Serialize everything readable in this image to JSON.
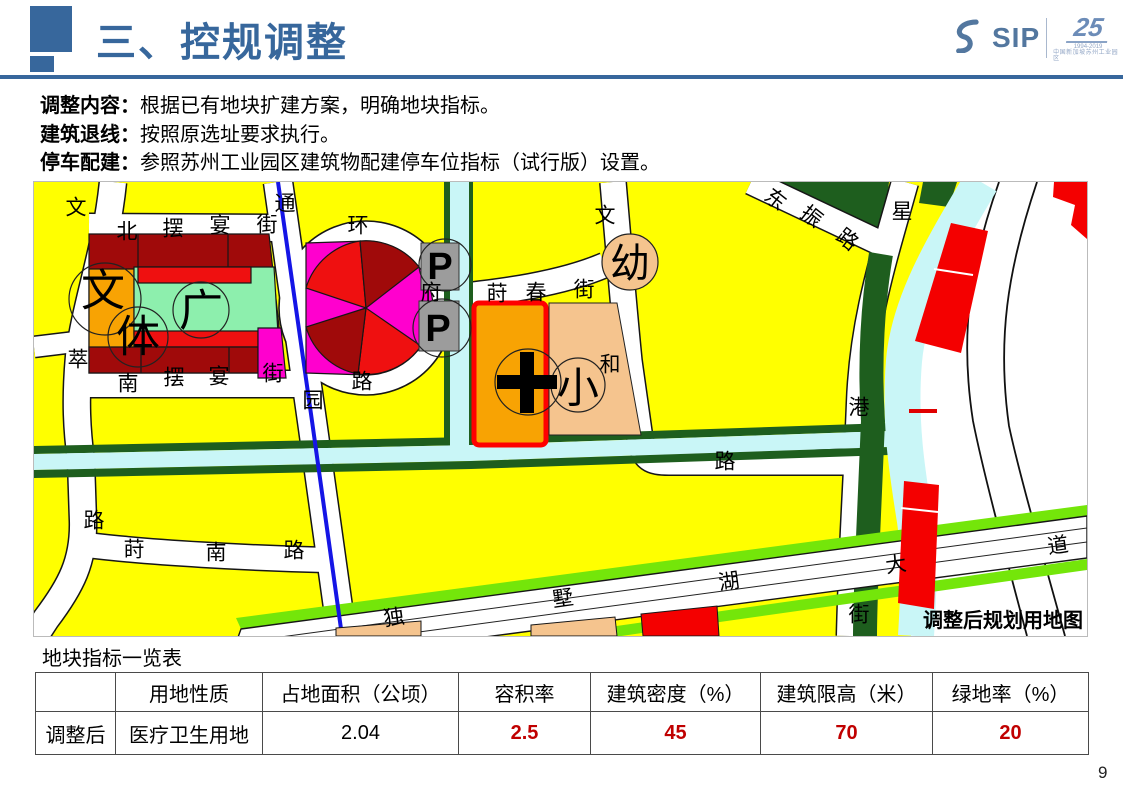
{
  "slide": {
    "title": "三、控规调整",
    "page_number": "9"
  },
  "logo": {
    "sip": "SIP",
    "anniversary": "25",
    "years": "1994-2019",
    "subtext": "中国新加坡苏州工业园区"
  },
  "bullets": [
    {
      "label": "调整内容：",
      "text": "根据已有地块扩建方案，明确地块指标。"
    },
    {
      "label": "建筑退线：",
      "text": "按照原选址要求执行。"
    },
    {
      "label": "停车配建：",
      "text": "参照苏州工业园区建筑物配建停车位指标（试行版）设置。"
    }
  ],
  "map": {
    "caption": "调整后规划用地图",
    "street_labels": [
      {
        "t": "文",
        "x": 75,
        "y": 207
      },
      {
        "t": "萃",
        "x": 77,
        "y": 359
      },
      {
        "t": "路",
        "x": 93,
        "y": 520
      },
      {
        "t": "北",
        "x": 126,
        "y": 231
      },
      {
        "t": "摆",
        "x": 172,
        "y": 228
      },
      {
        "t": "宴",
        "x": 219,
        "y": 225
      },
      {
        "t": "街",
        "x": 266,
        "y": 224
      },
      {
        "t": "通",
        "x": 284,
        "y": 203
      },
      {
        "t": "园",
        "x": 312,
        "y": 400
      },
      {
        "t": "环",
        "x": 357,
        "y": 225
      },
      {
        "t": "府",
        "x": 430,
        "y": 292
      },
      {
        "t": "路",
        "x": 361,
        "y": 381
      },
      {
        "t": "南",
        "x": 127,
        "y": 383
      },
      {
        "t": "摆",
        "x": 173,
        "y": 377
      },
      {
        "t": "宴",
        "x": 218,
        "y": 376
      },
      {
        "t": "街",
        "x": 272,
        "y": 373
      },
      {
        "t": "莳",
        "x": 496,
        "y": 293
      },
      {
        "t": "春",
        "x": 535,
        "y": 292
      },
      {
        "t": "街",
        "x": 583,
        "y": 289
      },
      {
        "t": "文",
        "x": 604,
        "y": 215
      },
      {
        "t": "和",
        "x": 609,
        "y": 364
      },
      {
        "t": "路",
        "x": 724,
        "y": 461
      },
      {
        "t": "东",
        "x": 774,
        "y": 199,
        "r": 38
      },
      {
        "t": "振",
        "x": 810,
        "y": 216,
        "r": 38
      },
      {
        "t": "路",
        "x": 846,
        "y": 239,
        "r": 38
      },
      {
        "t": "星",
        "x": 901,
        "y": 211
      },
      {
        "t": "港",
        "x": 858,
        "y": 407
      },
      {
        "t": "街",
        "x": 858,
        "y": 614
      },
      {
        "t": "莳",
        "x": 133,
        "y": 549
      },
      {
        "t": "南",
        "x": 215,
        "y": 552
      },
      {
        "t": "路",
        "x": 293,
        "y": 550
      },
      {
        "t": "独",
        "x": 393,
        "y": 617,
        "r": -8
      },
      {
        "t": "墅",
        "x": 562,
        "y": 598,
        "r": -8
      },
      {
        "t": "湖",
        "x": 728,
        "y": 581,
        "r": -8
      },
      {
        "t": "大",
        "x": 895,
        "y": 564,
        "r": -8
      },
      {
        "t": "道",
        "x": 1057,
        "y": 545,
        "r": -8
      }
    ],
    "landmark_labels": [
      {
        "t": "文",
        "x": 102,
        "y": 290,
        "s": 44
      },
      {
        "t": "体",
        "x": 137,
        "y": 336,
        "s": 44
      },
      {
        "t": "广",
        "x": 200,
        "y": 310,
        "s": 44
      },
      {
        "t": "幼",
        "x": 629,
        "y": 263,
        "s": 40
      },
      {
        "t": "小",
        "x": 577,
        "y": 387,
        "s": 42
      }
    ],
    "parking_labels": [
      {
        "t": "P",
        "x": 439,
        "y": 266,
        "s": 38,
        "w": 700
      },
      {
        "t": "P",
        "x": 437,
        "y": 328,
        "s": 38,
        "w": 700
      }
    ]
  },
  "table": {
    "title": "地块指标一览表",
    "headers": [
      "",
      "用地性质",
      "占地面积（公顷）",
      "容积率",
      "建筑密度（%）",
      "建筑限高（米）",
      "绿地率（%）"
    ],
    "row": [
      "调整后",
      "医疗卫生用地",
      "2.04",
      "2.5",
      "45",
      "70",
      "20"
    ]
  },
  "colors": {
    "accent_blue": "#37679C",
    "table_value_red": "#C00000",
    "residential_yellow": "#FFFF00",
    "commercial_darkred": "#A00A0A",
    "commercial_red": "#EF1010",
    "entertainment_magenta": "#FF00CE",
    "culture_orange": "#F8A303",
    "school_tan": "#F5C48E",
    "plaza_mint": "#8DEFAD",
    "parking_gray": "#9C9C9C",
    "water_cyan": "#C9F6F7",
    "greenbelt_dark": "#1E5E1E",
    "roadside_lime": "#74E60A",
    "metro_blue": "#1515E6",
    "hospital_outline_red": "#FF0000"
  }
}
